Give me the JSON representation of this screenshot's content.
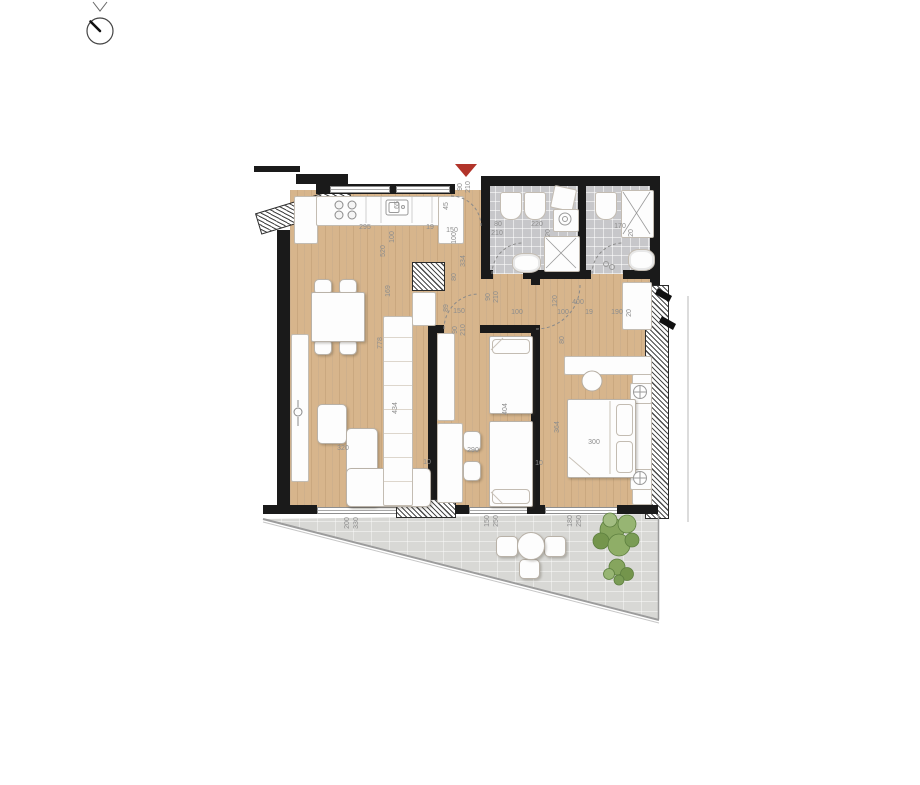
{
  "plan": {
    "type": "apartment-floor-plan",
    "entrance_marker": "triangle-down",
    "colors": {
      "wall": "#1a1a1a",
      "wood_floor": "#d7b58c",
      "bath_tile": "#c7c7ca",
      "terrace": "#d8d8d5",
      "accent_red": "#b2342a",
      "plant_green": "#7a9c55",
      "dimension_text": "#8d8d8d"
    },
    "dimensions": [
      {
        "t": "295",
        "x": 365,
        "y": 228,
        "o": "h"
      },
      {
        "t": "65",
        "x": 398,
        "y": 205,
        "o": "v"
      },
      {
        "t": "100",
        "x": 393,
        "y": 237,
        "o": "v"
      },
      {
        "t": "520",
        "x": 384,
        "y": 251,
        "o": "v"
      },
      {
        "t": "19",
        "x": 430,
        "y": 228,
        "o": "h"
      },
      {
        "t": "150",
        "x": 452,
        "y": 231,
        "o": "h"
      },
      {
        "t": "45",
        "x": 447,
        "y": 206,
        "o": "v"
      },
      {
        "t": "90",
        "x": 461,
        "y": 187,
        "o": "v"
      },
      {
        "t": "210",
        "x": 469,
        "y": 187,
        "o": "v"
      },
      {
        "t": "100",
        "x": 455,
        "y": 238,
        "o": "v"
      },
      {
        "t": "334",
        "x": 464,
        "y": 261,
        "o": "v"
      },
      {
        "t": "80",
        "x": 455,
        "y": 277,
        "o": "v"
      },
      {
        "t": "80",
        "x": 498,
        "y": 225,
        "o": "h"
      },
      {
        "t": "210",
        "x": 497,
        "y": 234,
        "o": "h"
      },
      {
        "t": "220",
        "x": 537,
        "y": 225,
        "o": "h"
      },
      {
        "t": "20",
        "x": 549,
        "y": 233,
        "o": "v"
      },
      {
        "t": "170",
        "x": 620,
        "y": 227,
        "o": "h"
      },
      {
        "t": "20",
        "x": 632,
        "y": 233,
        "o": "v"
      },
      {
        "t": "90",
        "x": 489,
        "y": 297,
        "o": "v"
      },
      {
        "t": "210",
        "x": 497,
        "y": 297,
        "o": "v"
      },
      {
        "t": "89",
        "x": 447,
        "y": 308,
        "o": "v"
      },
      {
        "t": "150",
        "x": 459,
        "y": 312,
        "o": "h"
      },
      {
        "t": "90",
        "x": 456,
        "y": 330,
        "o": "v"
      },
      {
        "t": "210",
        "x": 464,
        "y": 330,
        "o": "v"
      },
      {
        "t": "120",
        "x": 556,
        "y": 301,
        "o": "v"
      },
      {
        "t": "400",
        "x": 578,
        "y": 303,
        "o": "h"
      },
      {
        "t": "100",
        "x": 517,
        "y": 313,
        "o": "h"
      },
      {
        "t": "100",
        "x": 563,
        "y": 313,
        "o": "h"
      },
      {
        "t": "19",
        "x": 589,
        "y": 313,
        "o": "h"
      },
      {
        "t": "190",
        "x": 617,
        "y": 313,
        "o": "h"
      },
      {
        "t": "20",
        "x": 630,
        "y": 313,
        "o": "v"
      },
      {
        "t": "80",
        "x": 563,
        "y": 340,
        "o": "v"
      },
      {
        "t": "169",
        "x": 389,
        "y": 291,
        "o": "v"
      },
      {
        "t": "778",
        "x": 381,
        "y": 343,
        "o": "v"
      },
      {
        "t": "434",
        "x": 396,
        "y": 408,
        "o": "v"
      },
      {
        "t": "320",
        "x": 343,
        "y": 449,
        "o": "h"
      },
      {
        "t": "10",
        "x": 427,
        "y": 463,
        "o": "h"
      },
      {
        "t": "290",
        "x": 473,
        "y": 451,
        "o": "h"
      },
      {
        "t": "404",
        "x": 506,
        "y": 409,
        "o": "v"
      },
      {
        "t": "10",
        "x": 539,
        "y": 464,
        "o": "h"
      },
      {
        "t": "364",
        "x": 558,
        "y": 427,
        "o": "v"
      },
      {
        "t": "300",
        "x": 594,
        "y": 443,
        "o": "h"
      },
      {
        "t": "200",
        "x": 348,
        "y": 523,
        "o": "v"
      },
      {
        "t": "330",
        "x": 357,
        "y": 523,
        "o": "v"
      },
      {
        "t": "150",
        "x": 488,
        "y": 521,
        "o": "v"
      },
      {
        "t": "250",
        "x": 497,
        "y": 521,
        "o": "v"
      },
      {
        "t": "180",
        "x": 571,
        "y": 521,
        "o": "v"
      },
      {
        "t": "250",
        "x": 580,
        "y": 521,
        "o": "v"
      }
    ]
  }
}
